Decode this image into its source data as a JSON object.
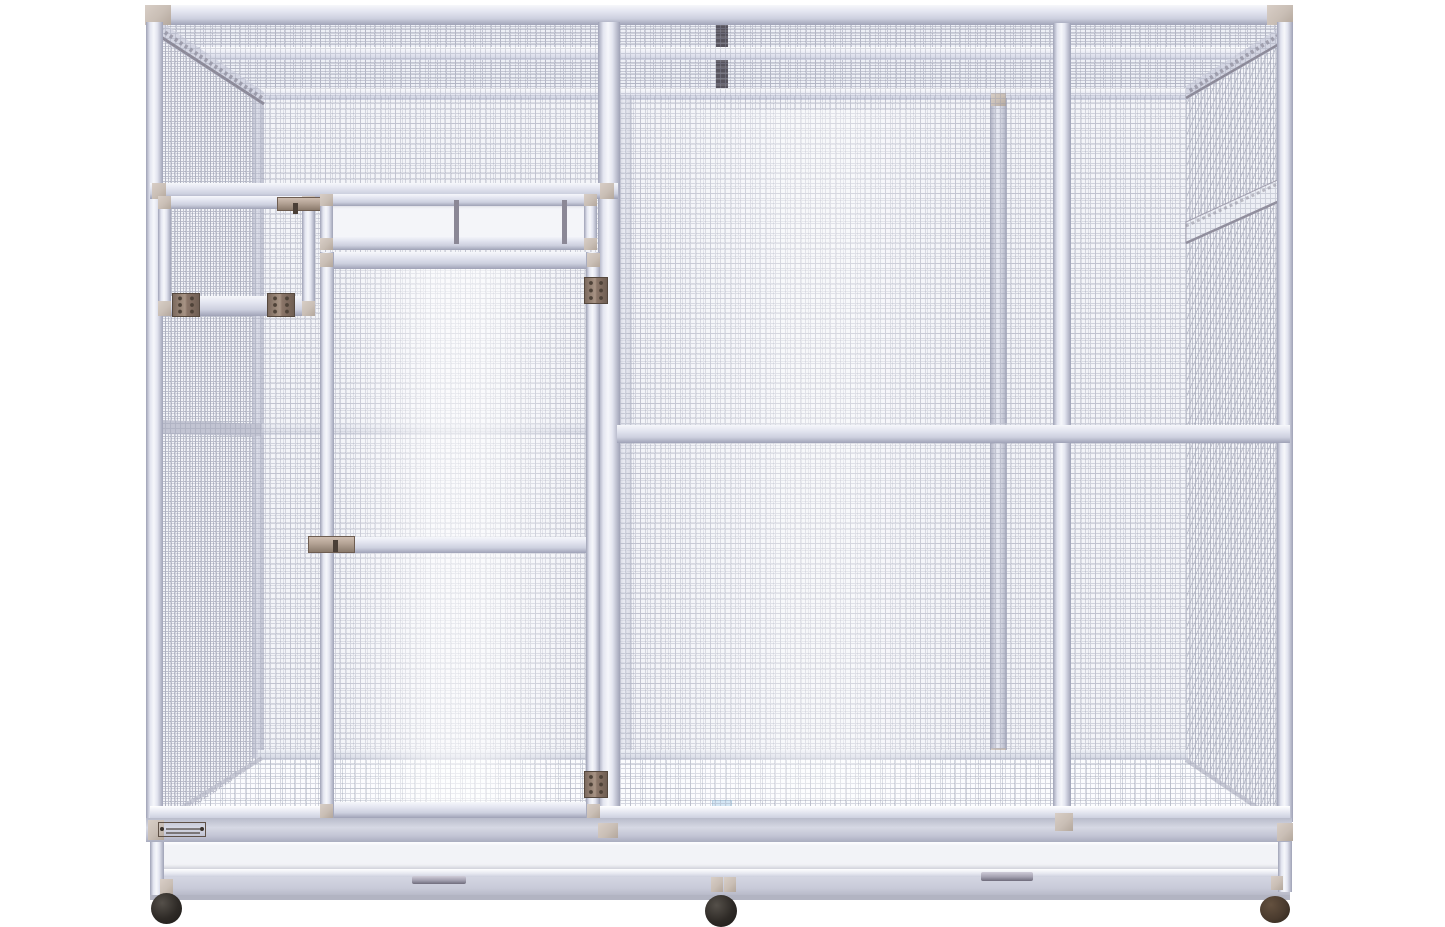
{
  "scene": {
    "type": "3d-product-render",
    "subject": "Large walk-in aluminium aviary bird cage with wire mesh panels and caster wheels",
    "background_color": "#ffffff",
    "visible_text": "none — only a small illegible brand plate at the lower left corner"
  },
  "colors": {
    "frame_highlight": "#f6f7fb",
    "frame_light": "#e3e5f0",
    "frame_mid": "#cdd0df",
    "frame_shadow": "#9fa2b6",
    "mesh_line": "#9296aa",
    "corner_cap": "#c9beb5",
    "hinge_metal": "#8a7568",
    "hinge_screw": "#4e4238",
    "latch_metal": "#b3a294",
    "clear_pane": "#f4f5f9",
    "pane_divider": "#8b8896",
    "roof_seam": "#57545e",
    "tray_face": "#f2f3f7",
    "base_band": "#c9cbd9",
    "base_edge": "#b2b4c2",
    "floor": "#fbfcfe",
    "water_dish": "#cfe4f4",
    "caster_dark": "#2e2a26",
    "caster_brown": "#4a3b2e",
    "label_plate": "#b3a294"
  },
  "components": {
    "roof": {
      "panel": "wire mesh roof",
      "seam_strip": "dark joint strip at top centre",
      "rails": [
        "front top rail",
        "mid purlin rail",
        "rear top rail"
      ]
    },
    "front_wall": {
      "posts": [
        "front-left corner post",
        "centre-left post",
        "mid-right post",
        "front-right corner post"
      ],
      "small_access_door": {
        "location": "upper left",
        "hinge_count": 2,
        "latch_count": 1
      },
      "transom_window": {
        "location": "above walk-in door",
        "pane_count": 3
      },
      "walk_in_door": {
        "location": "left of centre",
        "hinge_count": 2,
        "latch_count": 1
      },
      "crossbar": "horizontal mid rail across right section"
    },
    "left_wall": {
      "panel": "wire mesh side wall",
      "mid_rail": true
    },
    "right_wall": {
      "panel": "wire mesh side wall",
      "window_band": "clear strip near top"
    },
    "interior": {
      "back_wall": "wire mesh with divider posts",
      "floor": "wire grate floor",
      "water_dish": "small blue dish at centre rear"
    },
    "base": {
      "tray_front": "white slide-out tray band",
      "handle_count": 2,
      "brand_plate": {
        "legible": false
      }
    },
    "casters": {
      "count": 3
    }
  }
}
